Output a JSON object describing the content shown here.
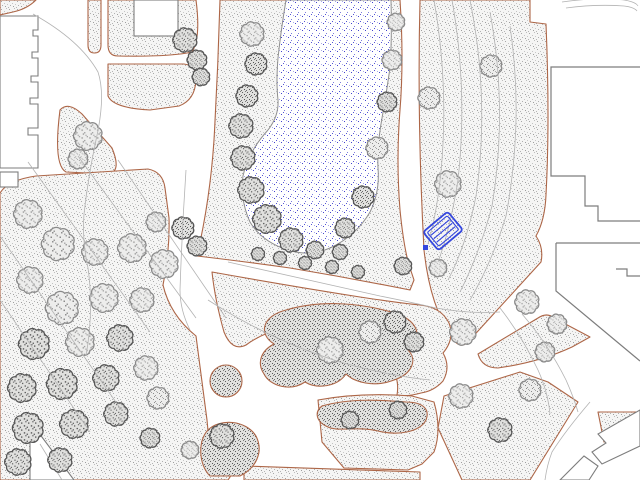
{
  "map": {
    "title": "landscape-site-plan",
    "description": "CAD park site plan with pond, lawns, tree canopies, shrub masses, footpaths, buildings and one selected bench object",
    "colors": {
      "background": "#ffffff",
      "lawn_edge": "#ad6647",
      "lawn_dot": "#9a9a9a",
      "tree_outline": "#6e6e6e",
      "shrub_dot": "#5a5a5a",
      "pond_dot": "#3c3ccc",
      "pond_outline": "#8f8f8f",
      "building_outline": "#7d7d7d",
      "contour_line": "#b3b3b3",
      "selection_blue": "#3547de"
    },
    "features": {
      "pond": {
        "label": "pond",
        "texture": "blue-stipple"
      },
      "bench": {
        "label": "bench (selected object)",
        "slats": 3,
        "grips": 1,
        "rotation_deg": -40
      },
      "lawns": {
        "label": "stippled lawn areas",
        "count": 15
      },
      "shrub_masses": {
        "label": "dense planting masses",
        "count": 4
      },
      "buildings": {
        "label": "building footprints",
        "count": 8
      },
      "contours": {
        "label": "survey / contour lines",
        "count": 16
      }
    },
    "trees": [
      [
        252,
        34,
        11,
        "l"
      ],
      [
        256,
        64,
        10,
        "d"
      ],
      [
        247,
        96,
        10,
        "d"
      ],
      [
        241,
        126,
        11,
        "d"
      ],
      [
        243,
        158,
        11,
        "d"
      ],
      [
        251,
        190,
        12,
        "d"
      ],
      [
        267,
        219,
        13,
        "d"
      ],
      [
        291,
        240,
        11,
        "d"
      ],
      [
        315,
        250,
        8,
        "d"
      ],
      [
        340,
        252,
        7,
        "d"
      ],
      [
        258,
        254,
        6,
        "d"
      ],
      [
        280,
        258,
        6,
        "d"
      ],
      [
        305,
        263,
        6,
        "d"
      ],
      [
        332,
        267,
        6,
        "d"
      ],
      [
        358,
        272,
        6,
        "d"
      ],
      [
        396,
        22,
        8,
        "l"
      ],
      [
        392,
        60,
        9,
        "l"
      ],
      [
        387,
        102,
        9,
        "d"
      ],
      [
        377,
        148,
        10,
        "l"
      ],
      [
        363,
        197,
        10,
        "d"
      ],
      [
        345,
        228,
        9,
        "d"
      ],
      [
        403,
        266,
        8,
        "d"
      ],
      [
        185,
        40,
        11,
        "d"
      ],
      [
        197,
        60,
        9,
        "d"
      ],
      [
        201,
        77,
        8,
        "d"
      ],
      [
        88,
        136,
        13,
        "l"
      ],
      [
        78,
        159,
        9,
        "l"
      ],
      [
        183,
        228,
        10,
        "d"
      ],
      [
        197,
        246,
        9,
        "d"
      ],
      [
        164,
        264,
        13,
        "l"
      ],
      [
        28,
        214,
        13,
        "l"
      ],
      [
        58,
        244,
        15,
        "l"
      ],
      [
        30,
        280,
        12,
        "l"
      ],
      [
        95,
        252,
        12,
        "l"
      ],
      [
        132,
        248,
        13,
        "l"
      ],
      [
        156,
        222,
        9,
        "l"
      ],
      [
        62,
        308,
        15,
        "l"
      ],
      [
        104,
        298,
        13,
        "l"
      ],
      [
        142,
        300,
        11,
        "l"
      ],
      [
        34,
        344,
        14,
        "d"
      ],
      [
        80,
        342,
        13,
        "l"
      ],
      [
        120,
        338,
        12,
        "d"
      ],
      [
        22,
        388,
        13,
        "d"
      ],
      [
        62,
        384,
        14,
        "d"
      ],
      [
        106,
        378,
        12,
        "d"
      ],
      [
        146,
        368,
        11,
        "l"
      ],
      [
        28,
        428,
        14,
        "d"
      ],
      [
        74,
        424,
        13,
        "d"
      ],
      [
        116,
        414,
        11,
        "d"
      ],
      [
        158,
        398,
        10,
        "l"
      ],
      [
        18,
        462,
        12,
        "d"
      ],
      [
        60,
        460,
        11,
        "d"
      ],
      [
        150,
        438,
        9,
        "d"
      ],
      [
        190,
        450,
        8,
        "l"
      ],
      [
        429,
        98,
        10,
        "l"
      ],
      [
        448,
        184,
        12,
        "l"
      ],
      [
        491,
        66,
        10,
        "l"
      ],
      [
        438,
        268,
        8,
        "l"
      ],
      [
        463,
        332,
        12,
        "l"
      ],
      [
        527,
        302,
        11,
        "l"
      ],
      [
        557,
        324,
        9,
        "l"
      ],
      [
        330,
        350,
        12,
        "l"
      ],
      [
        370,
        332,
        10,
        "l"
      ],
      [
        395,
        322,
        10,
        "d"
      ],
      [
        414,
        342,
        9,
        "d"
      ],
      [
        350,
        420,
        8,
        "d"
      ],
      [
        398,
        410,
        8,
        "d"
      ],
      [
        222,
        436,
        11,
        "d"
      ],
      [
        461,
        396,
        11,
        "l"
      ],
      [
        500,
        430,
        11,
        "d"
      ],
      [
        530,
        390,
        10,
        "l"
      ],
      [
        545,
        352,
        9,
        "l"
      ]
    ]
  }
}
